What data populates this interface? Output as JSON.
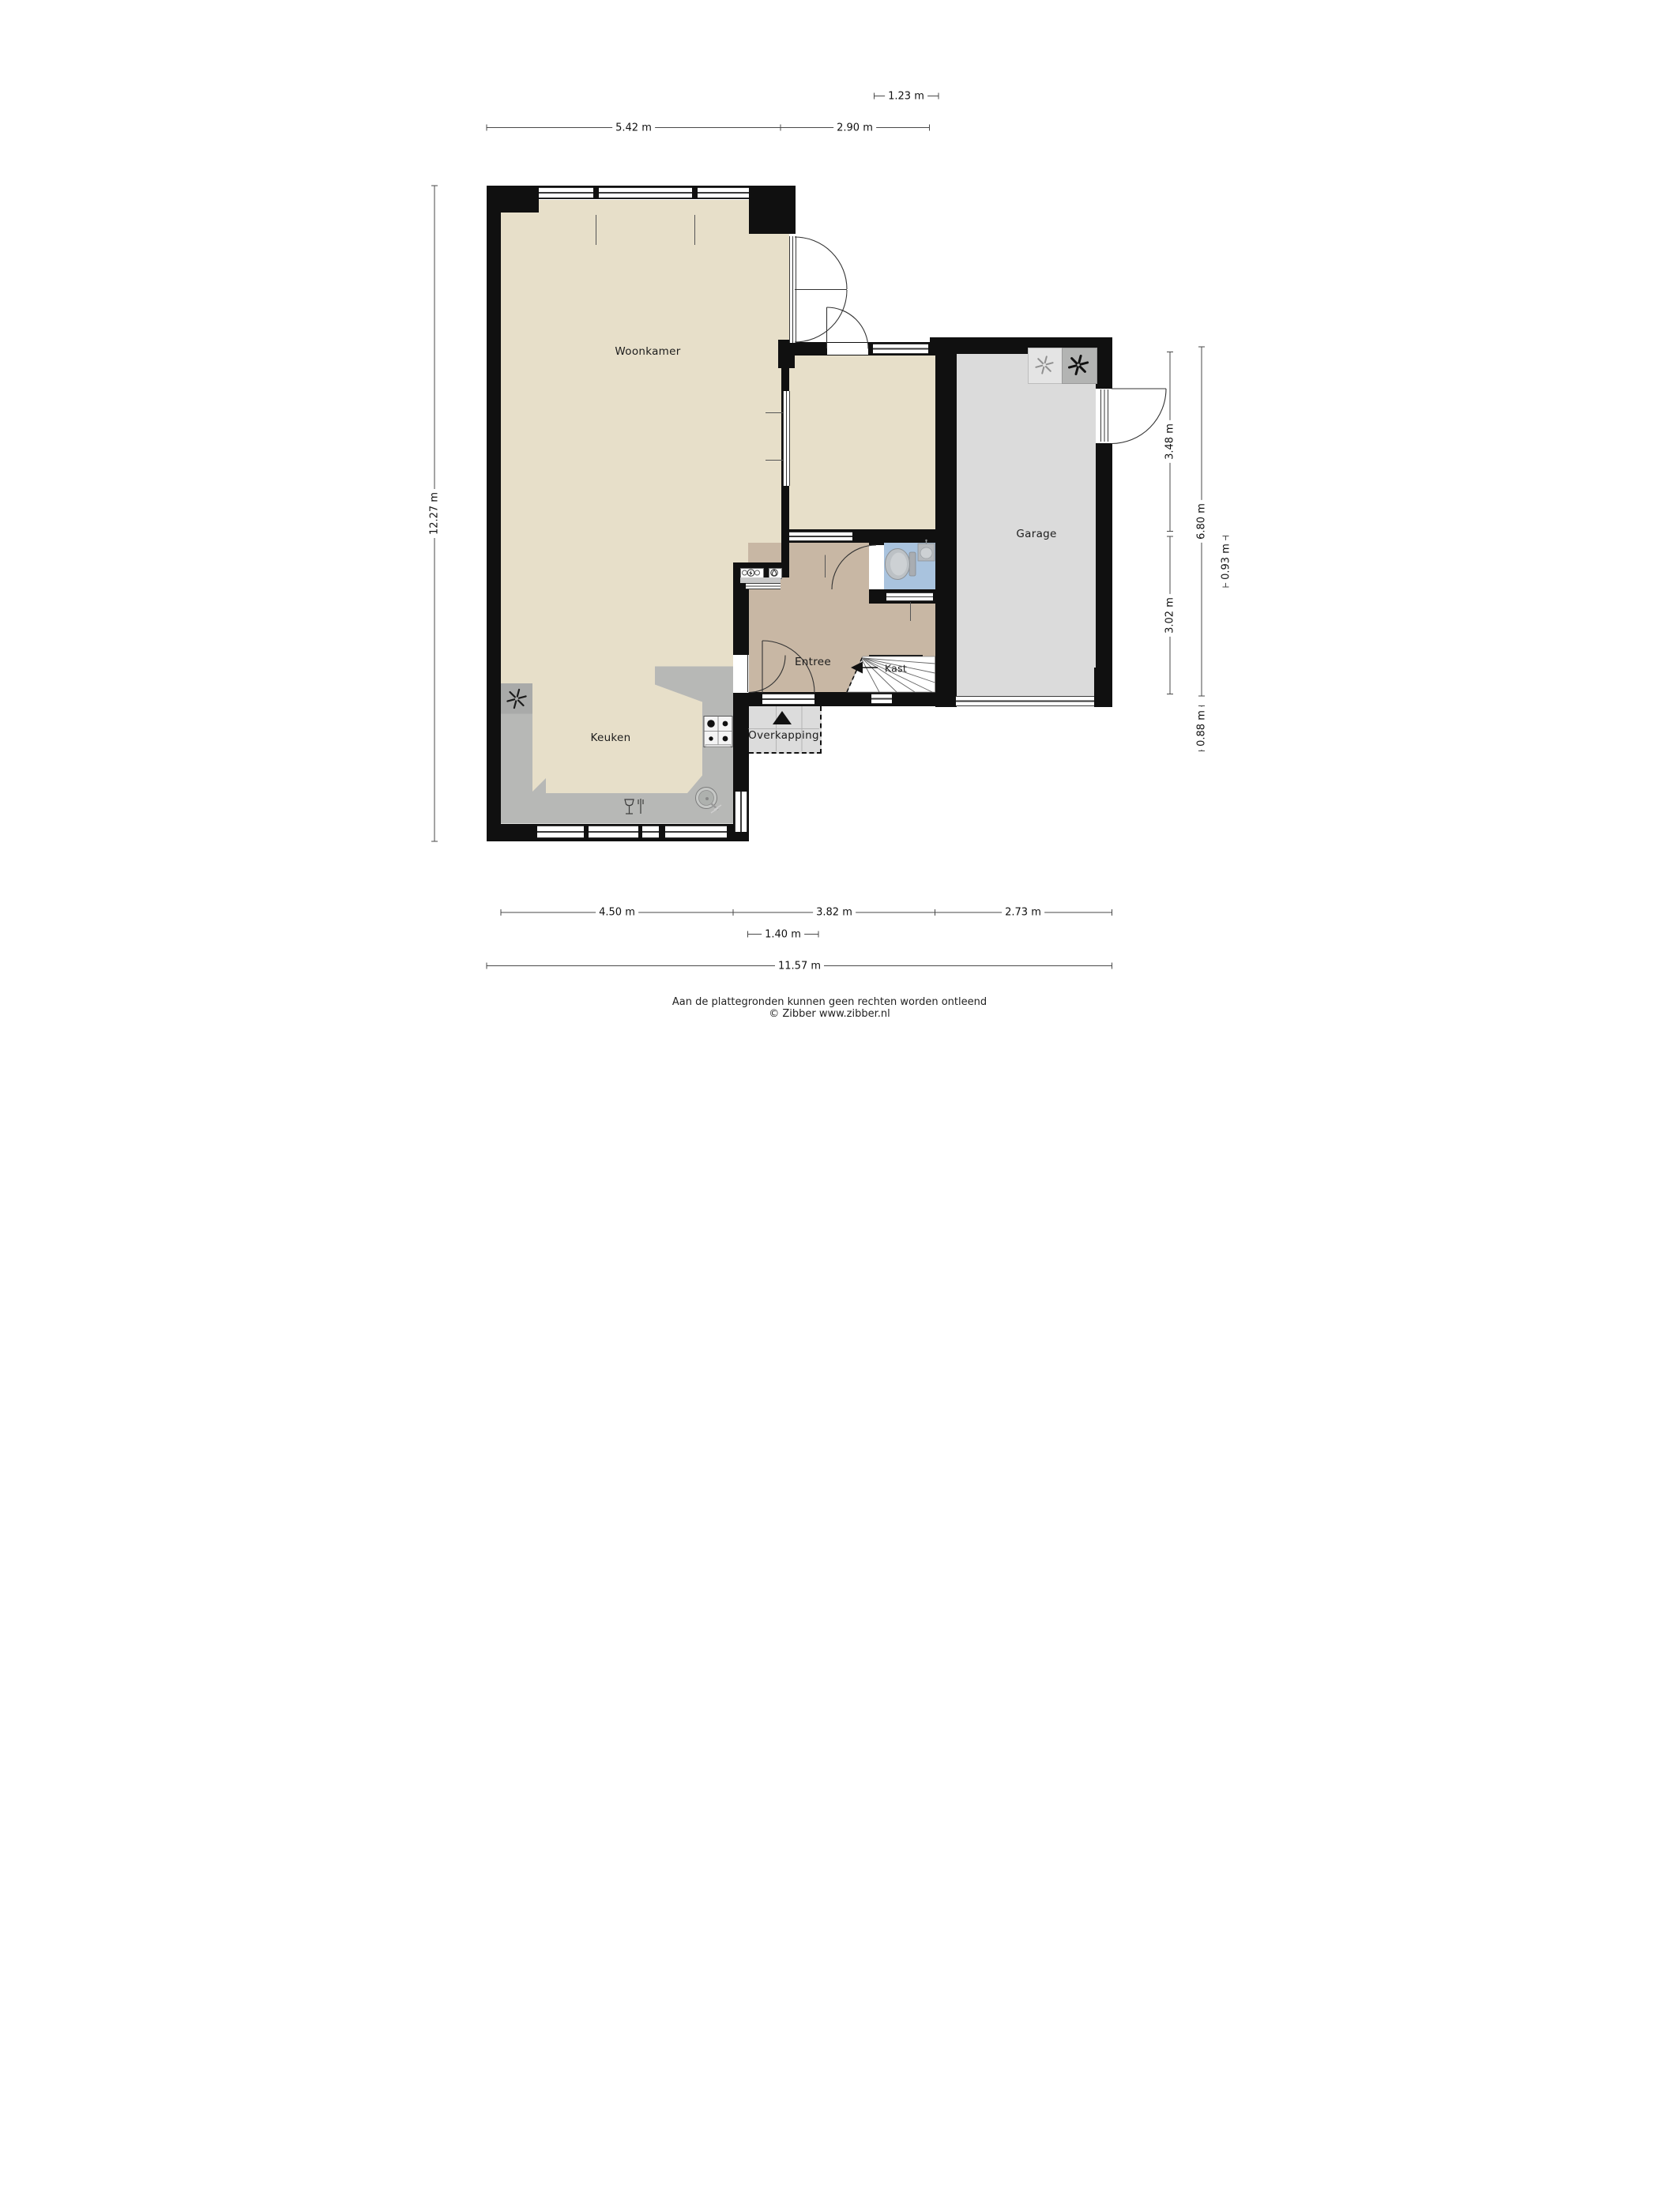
{
  "plan": {
    "title": "floorplan-ground-floor",
    "rooms": [
      {
        "id": "woonkamer",
        "label": "Woonkamer"
      },
      {
        "id": "keuken",
        "label": "Keuken"
      },
      {
        "id": "entree",
        "label": "Entree"
      },
      {
        "id": "kast",
        "label": "Kast"
      },
      {
        "id": "garage",
        "label": "Garage"
      },
      {
        "id": "overkapping",
        "label": "Overkapping"
      }
    ],
    "colors": {
      "wall": "#101010",
      "floor_living": "#e7dfc9",
      "floor_entree": "#c8b7a4",
      "floor_toilet": "#a9c3de",
      "floor_garage": "#dbdbdb",
      "floor_overkapping": "#dcdcdc",
      "counter": "#b7b8b6"
    },
    "icons": {
      "ventilation-fan": "six-blade asterisk",
      "washer": "light square with thin asterisk",
      "dryer": "dark square with bold asterisk",
      "electric-meter": "circle with lightning bolt",
      "water-meter": "circle with water drop",
      "stove": "four-burner hob",
      "sink": "round basin with tap",
      "dishwasher": "glass and fork symbol",
      "toilet": "bowl with cistern",
      "washbasin": "small basin with tap",
      "entrance-arrow": "solid triangle pointing up",
      "stairs-arrow": "solid triangle pointing left"
    }
  },
  "dimensions": {
    "top": [
      {
        "label": "1.23 m"
      },
      {
        "label": "5.42 m"
      },
      {
        "label": "2.90 m"
      }
    ],
    "left": [
      {
        "label": "12.27 m"
      }
    ],
    "right": [
      {
        "label": "3.48 m"
      },
      {
        "label": "3.02 m"
      },
      {
        "label": "6.80 m"
      },
      {
        "label": "0.93 m"
      },
      {
        "label": "0.88 m"
      }
    ],
    "bottom": [
      {
        "label": "4.50 m"
      },
      {
        "label": "3.82 m"
      },
      {
        "label": "2.73 m"
      },
      {
        "label": "1.40 m"
      },
      {
        "label": "11.57 m"
      }
    ]
  },
  "footer": {
    "disclaimer": "Aan de plattegronden kunnen geen rechten worden ontleend",
    "copyright": "© Zibber www.zibber.nl"
  }
}
